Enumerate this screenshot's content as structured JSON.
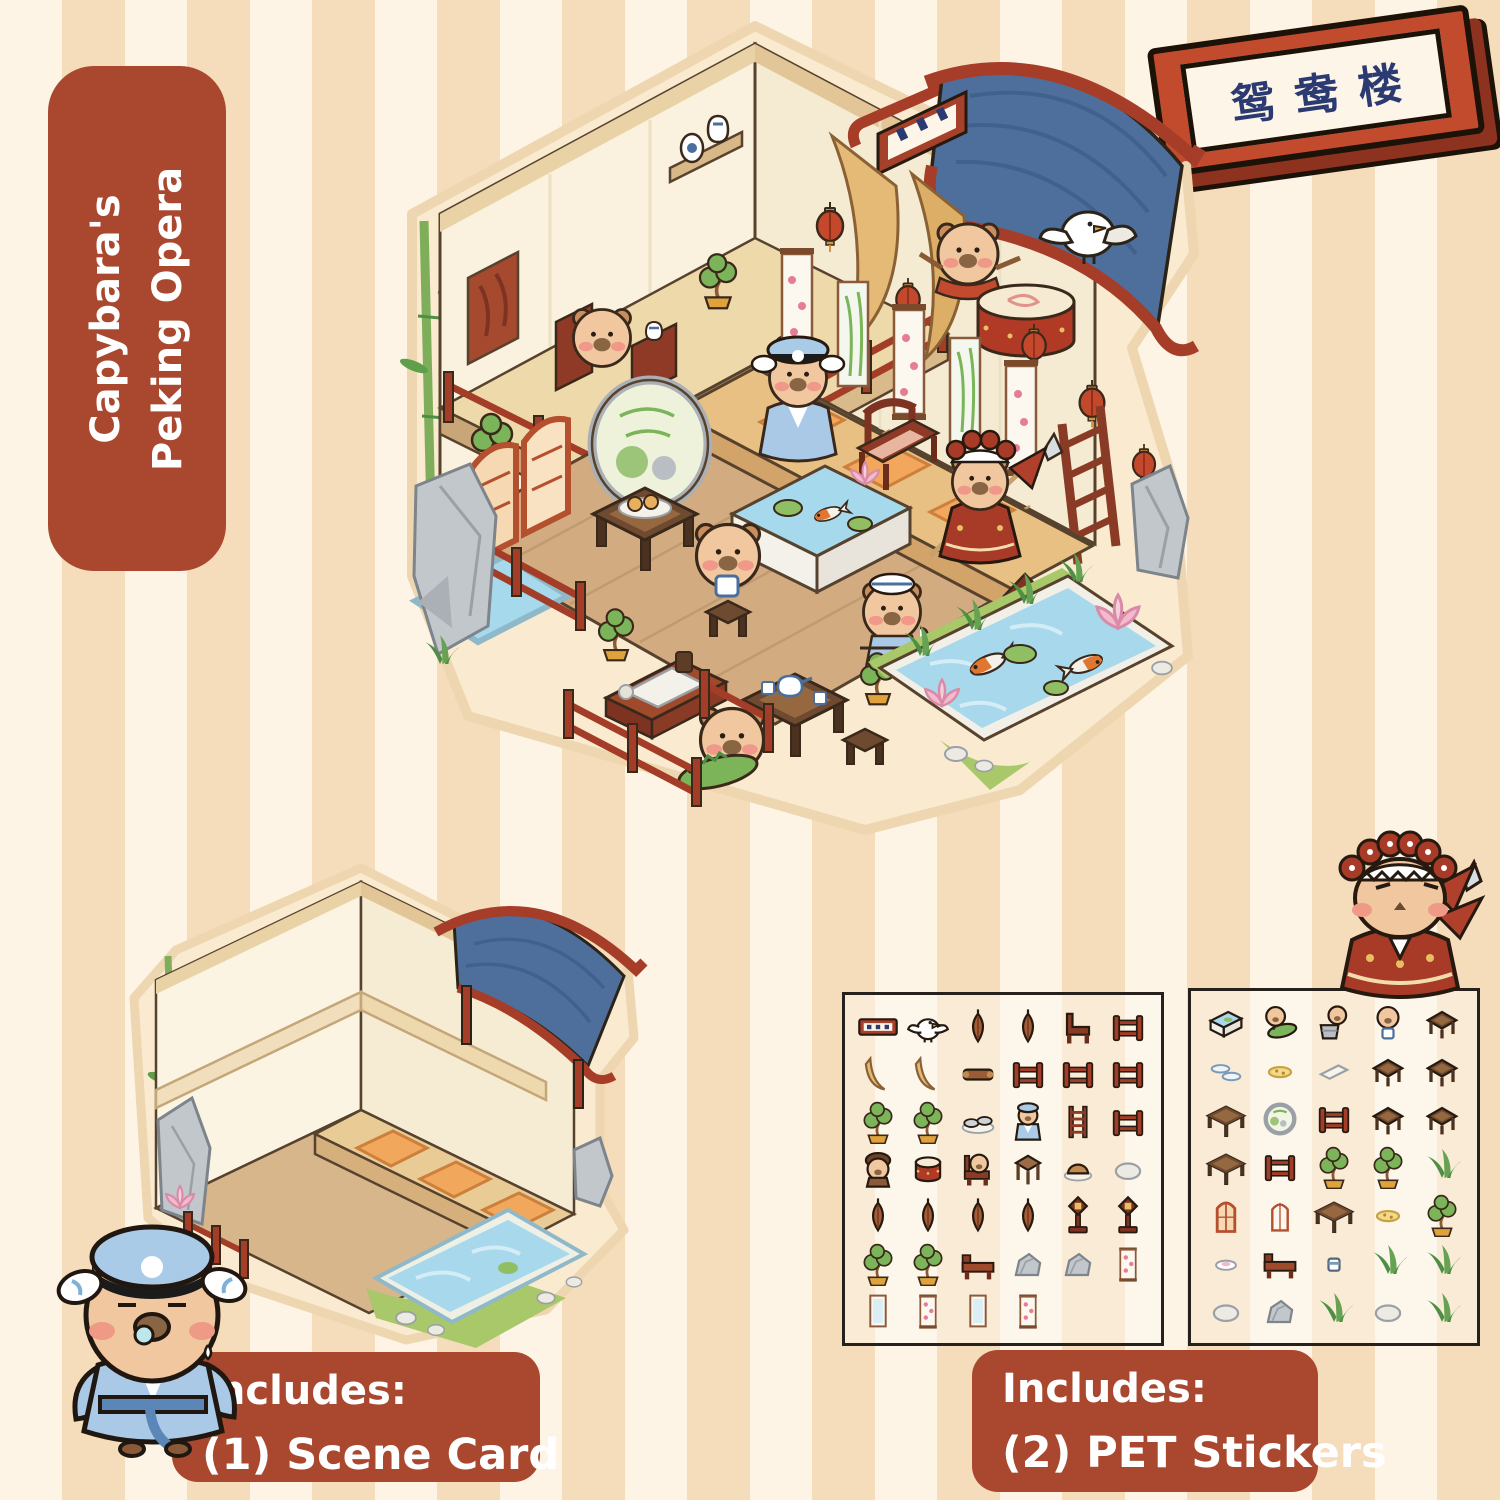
{
  "badge": {
    "line1": "Capybara's",
    "line2": "Peking Opera"
  },
  "plaque": {
    "text": "鸳鸯楼"
  },
  "includes_scene_card": {
    "heading": "Includes:",
    "item": "(1) Scene Card"
  },
  "includes_stickers": {
    "heading": "Includes:",
    "item": "(2) PET Stickers"
  },
  "colors": {
    "badge_bg": "#a9482e",
    "plaque_red": "#c24b2e",
    "plaque_text_navy": "#2c3a72",
    "stripe_light": "#fdf4e6",
    "stripe_dark": "#f5dcba",
    "roof_blue": "#4e6f9c",
    "wood_red": "#a33d27",
    "water_blue": "#a8d8ec",
    "capybara_tan": "#f0c79e"
  },
  "sticker_sheets": [
    {
      "name": "sheet-1",
      "items": [
        "sign",
        "bird",
        "leaf-lantern",
        "leaf-lantern",
        "armchair",
        "fence",
        "drape",
        "drape",
        "scroll",
        "fence",
        "fence",
        "fence",
        "bonsai",
        "bonsai",
        "shoes",
        "capy-blue",
        "ladder",
        "fence",
        "capy-brown",
        "drum",
        "capy-chair",
        "stool",
        "bun",
        "pebble",
        "leaf-lantern",
        "leaf-lantern",
        "leaf-lantern",
        "leaf-lantern",
        "stand-lamp",
        "stand-lamp",
        "bonsai",
        "bonsai",
        "bench",
        "rock",
        "rock",
        "wall-scroll",
        "window",
        "wall-scroll",
        "window",
        "wall-scroll"
      ]
    },
    {
      "name": "sheet-2",
      "items": [
        "pond-tub",
        "capy-croc",
        "capy-basket",
        "capy-cup",
        "small-table",
        "plates",
        "plate",
        "tray",
        "small-table",
        "small-table",
        "table",
        "moon-window",
        "fence",
        "small-table",
        "small-table",
        "table",
        "fence",
        "bonsai",
        "bonsai",
        "grass",
        "arch-door",
        "arch-window",
        "table",
        "plate",
        "bonsai",
        "dish",
        "bench",
        "cup",
        "grass",
        "grass",
        "pebble",
        "rock",
        "grass",
        "pebble",
        "grass"
      ]
    }
  ]
}
